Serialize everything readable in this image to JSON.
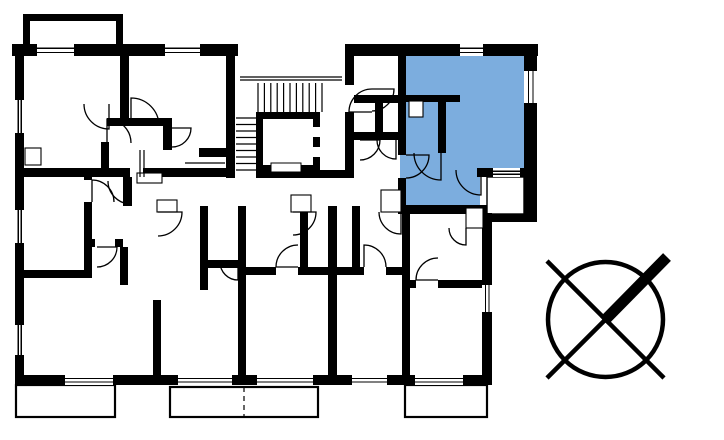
{
  "scene": {
    "type": "floor-plan",
    "background_color": "#FFFFFF",
    "wall_color": "#000000",
    "line_color": "#000000",
    "highlight_color": "#7CADDE"
  },
  "highlighted_unit": {
    "polygon": [
      [
        400,
        56
      ],
      [
        524,
        56
      ],
      [
        524,
        168
      ],
      [
        480,
        168
      ],
      [
        480,
        205
      ],
      [
        400,
        205
      ]
    ]
  },
  "walls": [
    [
      12,
      44,
      226,
      12
    ],
    [
      345,
      44,
      193,
      12
    ],
    [
      15,
      44,
      9,
      341
    ],
    [
      15,
      375,
      475,
      10
    ],
    [
      482,
      213,
      10,
      172
    ],
    [
      524,
      56,
      13,
      166
    ],
    [
      482,
      214,
      55,
      8
    ],
    [
      477,
      168,
      47,
      9
    ],
    [
      398,
      205,
      89,
      9
    ],
    [
      398,
      56,
      8,
      99
    ],
    [
      398,
      178,
      8,
      27
    ],
    [
      398,
      95,
      62,
      7
    ],
    [
      438,
      95,
      8,
      58
    ],
    [
      226,
      44,
      9,
      134
    ],
    [
      345,
      44,
      9,
      132
    ],
    [
      354,
      95,
      44,
      8
    ],
    [
      375,
      103,
      8,
      35
    ],
    [
      354,
      132,
      44,
      8
    ],
    [
      256,
      170,
      98,
      8
    ],
    [
      16,
      168,
      114,
      9
    ],
    [
      143,
      168,
      84,
      9
    ],
    [
      123,
      177,
      9,
      29
    ],
    [
      238,
      206,
      8,
      169
    ],
    [
      200,
      206,
      8,
      84
    ],
    [
      208,
      260,
      30,
      8
    ],
    [
      84,
      174,
      8,
      104
    ],
    [
      16,
      270,
      68,
      8
    ],
    [
      92,
      239,
      31,
      8
    ],
    [
      120,
      247,
      8,
      38
    ],
    [
      153,
      300,
      8,
      75
    ],
    [
      300,
      206,
      8,
      61
    ],
    [
      246,
      267,
      82,
      8
    ],
    [
      328,
      206,
      9,
      169
    ],
    [
      352,
      206,
      8,
      61
    ],
    [
      337,
      267,
      65,
      8
    ],
    [
      402,
      214,
      8,
      161
    ],
    [
      410,
      280,
      72,
      8
    ],
    [
      120,
      56,
      9,
      62
    ],
    [
      107,
      118,
      57,
      8
    ],
    [
      163,
      118,
      9,
      32
    ],
    [
      199,
      148,
      28,
      9
    ],
    [
      101,
      142,
      8,
      28
    ],
    [
      23,
      14,
      7,
      33
    ],
    [
      23,
      14,
      100,
      7
    ],
    [
      116,
      14,
      7,
      33
    ]
  ],
  "wall_gaps": [
    [
      95,
      239,
      20,
      8
    ],
    [
      84,
      180,
      8,
      22
    ],
    [
      276,
      267,
      22,
      8
    ],
    [
      364,
      267,
      22,
      8
    ],
    [
      416,
      280,
      22,
      8
    ],
    [
      345,
      85,
      9,
      27
    ]
  ],
  "windows_horizontal": [
    [
      37,
      44,
      37,
      12
    ],
    [
      165,
      44,
      35,
      12
    ],
    [
      460,
      44,
      23,
      12
    ],
    [
      65,
      375,
      48,
      10
    ],
    [
      178,
      375,
      54,
      10
    ],
    [
      257,
      375,
      56,
      10
    ],
    [
      352,
      375,
      35,
      10
    ],
    [
      415,
      375,
      48,
      10
    ],
    [
      493,
      168,
      27,
      9
    ]
  ],
  "windows_vertical": [
    [
      15,
      100,
      9,
      33
    ],
    [
      15,
      210,
      9,
      33
    ],
    [
      15,
      325,
      9,
      30
    ],
    [
      524,
      71,
      13,
      32
    ],
    [
      482,
      285,
      10,
      27
    ]
  ],
  "door_arcs": [
    [
      131,
      181,
      23,
      90,
      180
    ],
    [
      172,
      128,
      19,
      0,
      90
    ],
    [
      131,
      126,
      28,
      270,
      360
    ],
    [
      109,
      104,
      25,
      90,
      180
    ],
    [
      107,
      143,
      24,
      270,
      360
    ],
    [
      372,
      112,
      23,
      180,
      270
    ],
    [
      372,
      89,
      22,
      0,
      90
    ],
    [
      360,
      140,
      20,
      0,
      90
    ],
    [
      396,
      140,
      19,
      90,
      180
    ],
    [
      441,
      153,
      27,
      90,
      180
    ],
    [
      481,
      170,
      25,
      90,
      180
    ],
    [
      406,
      155,
      23,
      0,
      90
    ],
    [
      158,
      212,
      24,
      0,
      90
    ],
    [
      293,
      212,
      23,
      0,
      90
    ],
    [
      401,
      212,
      22,
      90,
      180
    ],
    [
      466,
      228,
      17,
      90,
      180
    ],
    [
      298,
      267,
      22,
      180,
      270
    ],
    [
      364,
      267,
      22,
      270,
      360
    ],
    [
      438,
      280,
      22,
      180,
      270
    ],
    [
      97,
      247,
      20,
      0,
      90
    ],
    [
      92,
      202,
      22,
      270,
      360
    ],
    [
      238,
      262,
      18,
      90,
      180
    ]
  ],
  "niche_boxes": [
    [
      157,
      200,
      20,
      12
    ],
    [
      291,
      195,
      20,
      17
    ],
    [
      381,
      190,
      20,
      22
    ],
    [
      466,
      208,
      17,
      20
    ],
    [
      409,
      101,
      14,
      16
    ],
    [
      25,
      148,
      16,
      17
    ],
    [
      137,
      173,
      25,
      10
    ]
  ],
  "balconies": [
    [
      16,
      385,
      99,
      32
    ],
    [
      170,
      387,
      148,
      30
    ],
    [
      405,
      385,
      82,
      32
    ]
  ],
  "balcony_divider": [
    244,
    387,
    244,
    417
  ],
  "loggia": [
    487,
    177,
    37,
    37
  ],
  "stairs": {
    "landing_lines": [
      [
        240,
        77,
        342,
        77
      ],
      [
        240,
        80,
        342,
        80
      ]
    ],
    "vertical_treads": {
      "x0": 258,
      "dx": 6.4,
      "count": 11,
      "y1": 83,
      "y2": 112
    },
    "horizontal_treads": {
      "y0": 118,
      "dy": 6.5,
      "count": 9,
      "x1": 236,
      "x2": 256
    }
  },
  "elevator": {
    "outer": [
      256,
      112,
      64,
      60
    ],
    "inner": [
      263,
      119,
      50,
      46
    ],
    "door_gaps": [
      [
        313,
        127,
        7,
        10
      ],
      [
        313,
        147,
        7,
        10
      ]
    ],
    "pit_box": [
      271,
      163,
      30,
      9
    ]
  },
  "extra_lines": [
    [
      140,
      150,
      140,
      177
    ],
    [
      144,
      150,
      144,
      177
    ],
    [
      185,
      163,
      225,
      163
    ]
  ],
  "north_indicator": {
    "cx": 605.5,
    "cy": 319.5,
    "r": 57.5,
    "ring_stroke": 4.5,
    "diagonal_full": [
      547,
      261,
      664,
      378
    ],
    "diagonal_half_thin": [
      547,
      378,
      606,
      319
    ],
    "thick_arm": [
      604,
      321,
      667,
      257
    ],
    "thick_arm_width": 11
  }
}
